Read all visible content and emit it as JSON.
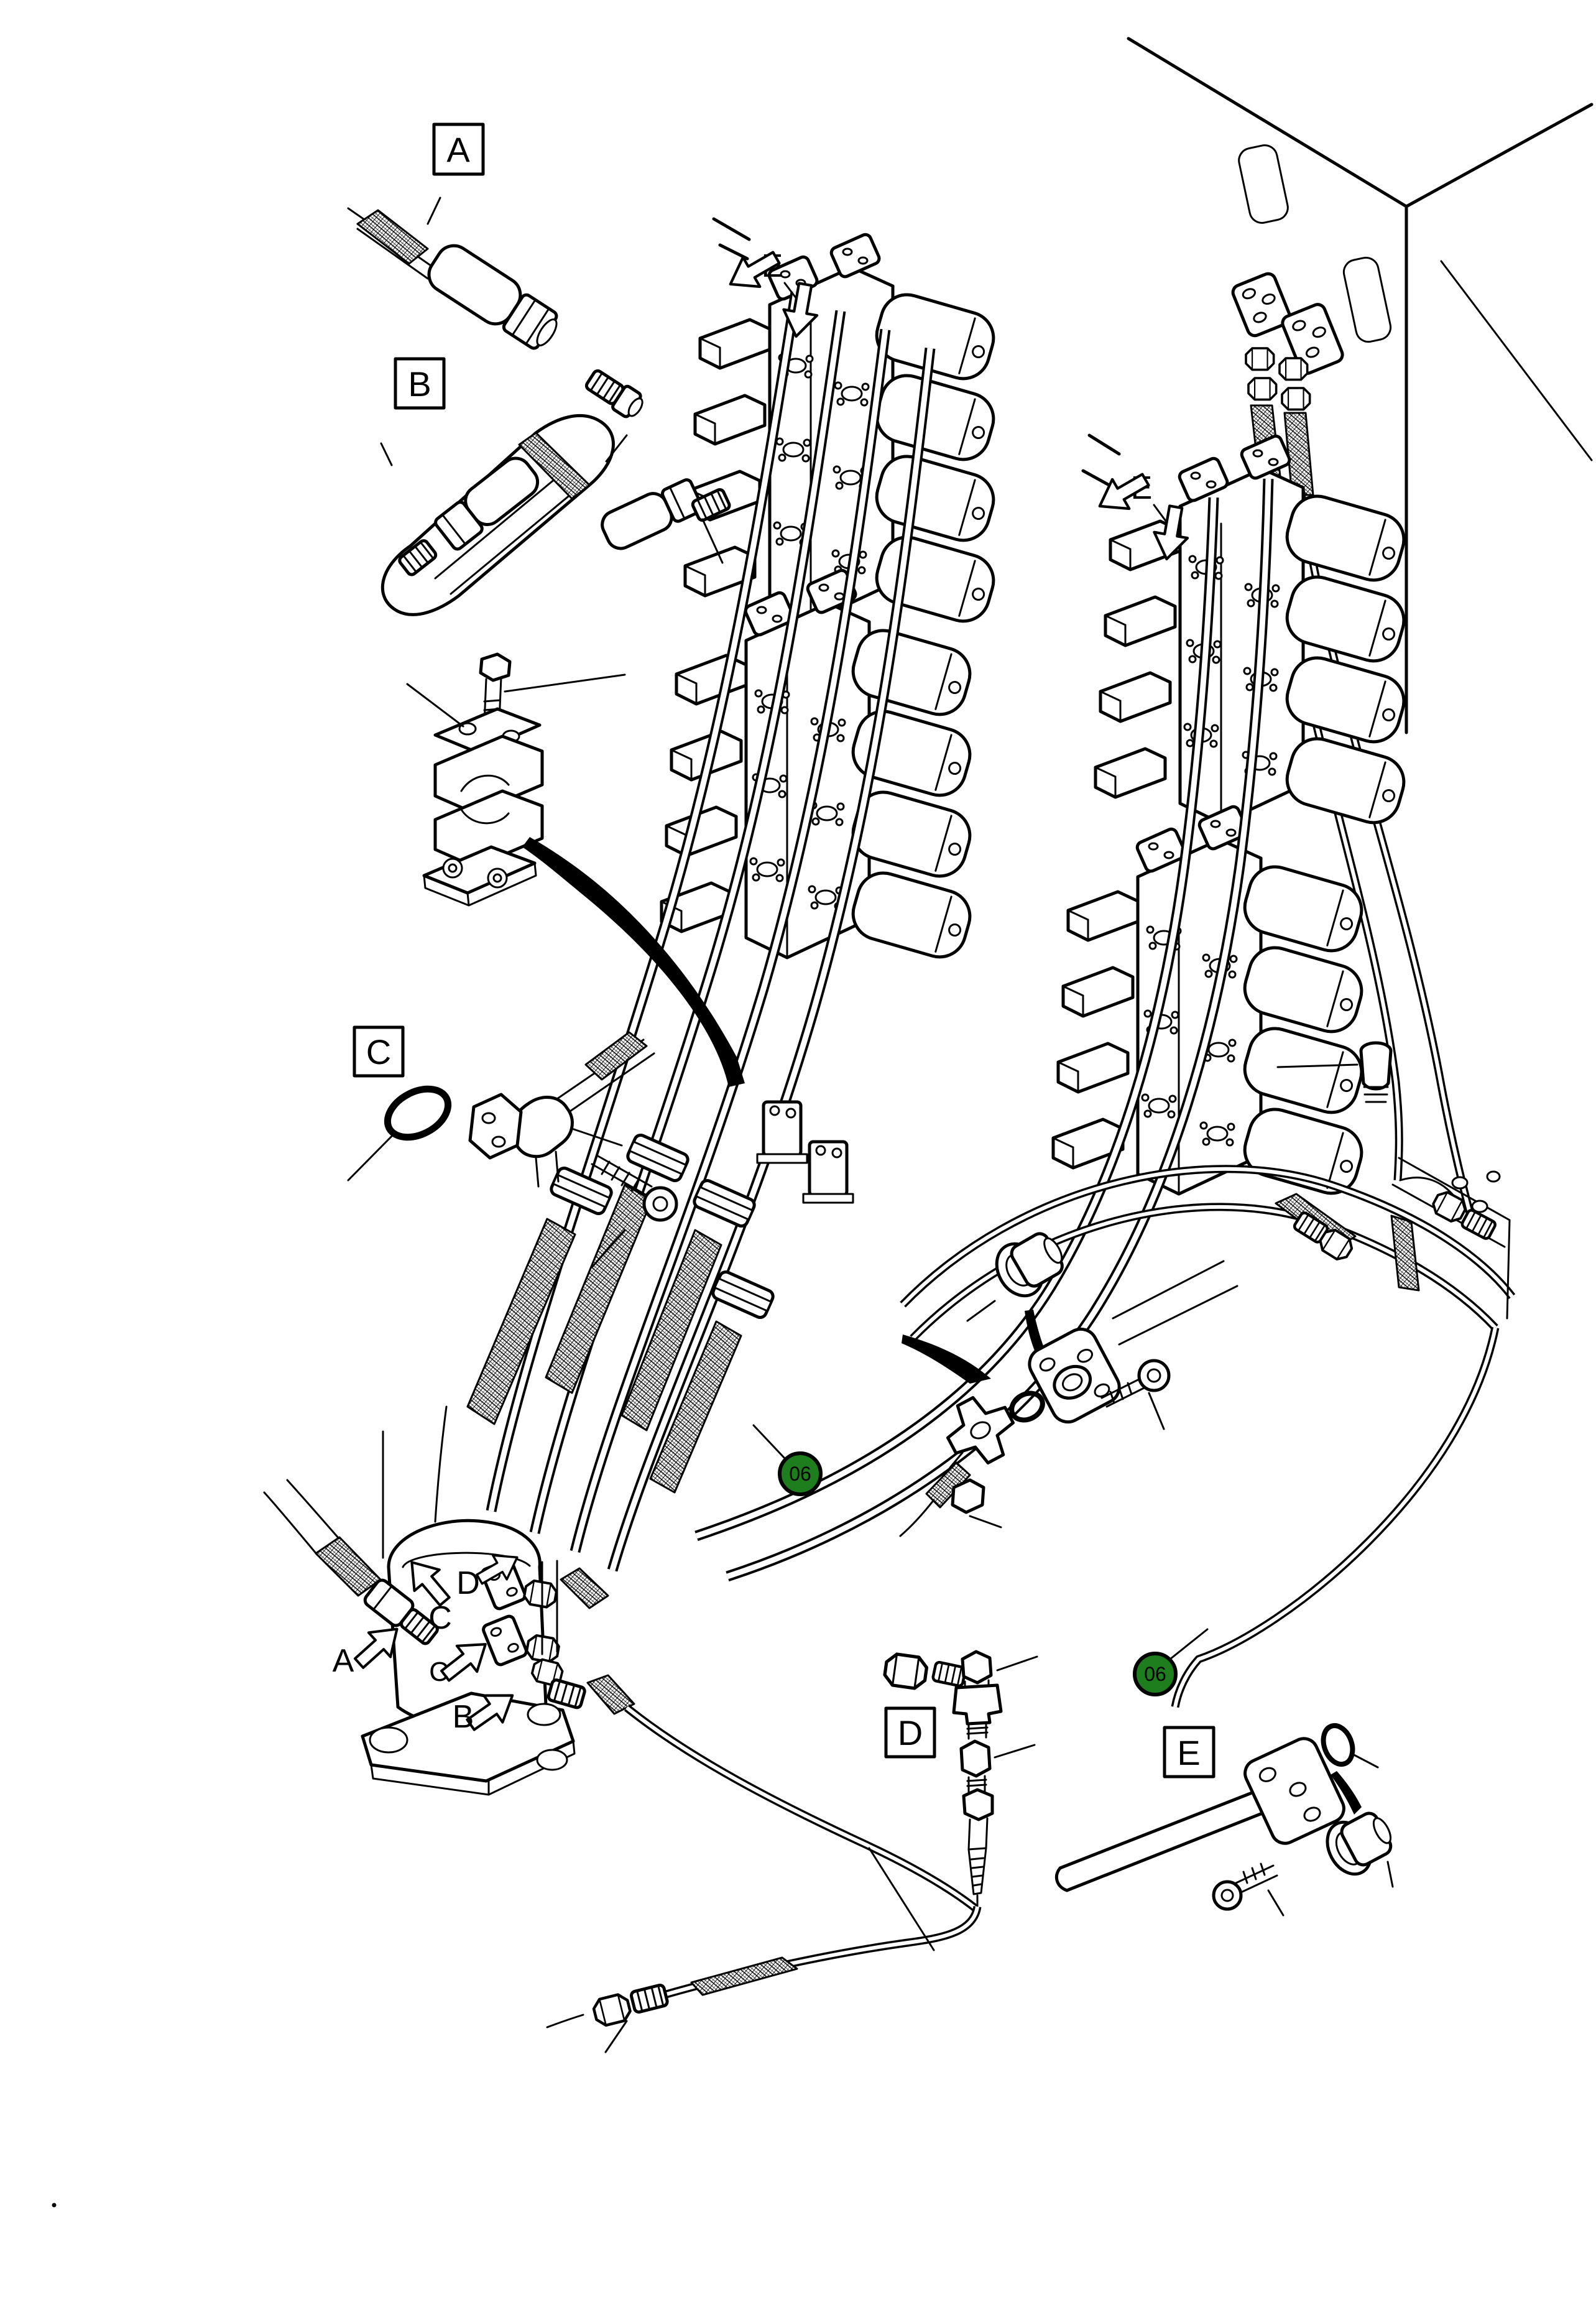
{
  "figure": {
    "background": "#ffffff",
    "line_color": "#000000"
  },
  "callout_boxes": {
    "a": "A",
    "b": "B",
    "c": "C",
    "d": "D",
    "e": "E"
  },
  "view_labels": {
    "e_manifold_left": "E",
    "e_manifold_right": "E"
  },
  "pump_port_labels": {
    "a": "A",
    "d": "D",
    "c_upper": "C",
    "c_lower": "C",
    "b": "B"
  },
  "part_badges": {
    "left": {
      "text": "06",
      "fill": "#1e7e1e",
      "text_color": "#ffffff"
    },
    "right": {
      "text": "06",
      "fill": "#1e7e1e",
      "text_color": "#ffffff"
    }
  }
}
